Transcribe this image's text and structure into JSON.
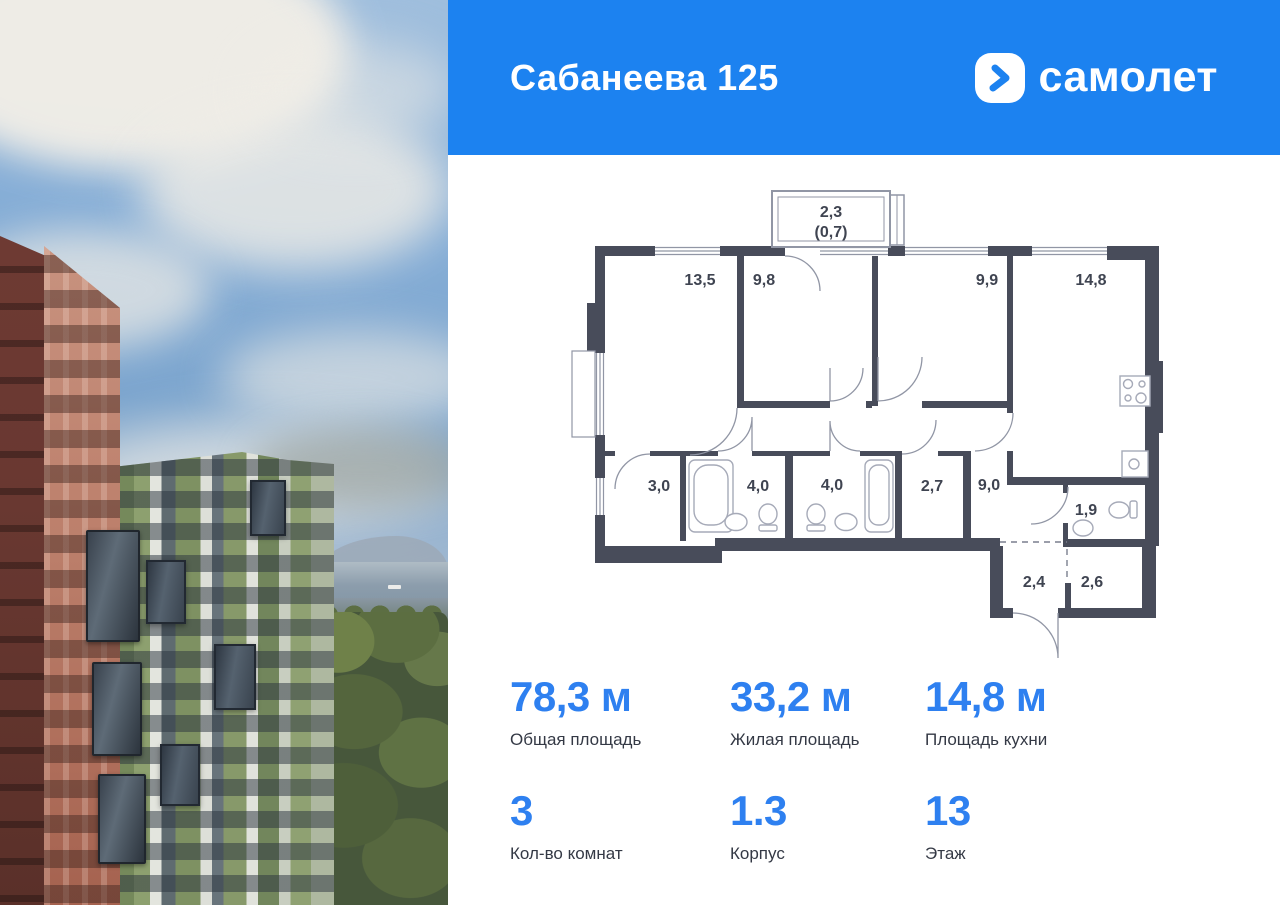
{
  "header": {
    "title": "Сабанеева 125",
    "brand": "самолет"
  },
  "colors": {
    "header_bg": "#1C82F0",
    "accent": "#2E80F0",
    "wall": "#484C5A",
    "plan_line": "#9196A5"
  },
  "plan": {
    "balcony": {
      "area": "2,3",
      "reduced": "(0,7)"
    },
    "room_areas": [
      "13,5",
      "9,8",
      "9,9",
      "14,8",
      "3,0",
      "4,0",
      "4,0",
      "2,7",
      "9,0",
      "1,9",
      "2,4",
      "2,6"
    ]
  },
  "stats": {
    "items": [
      {
        "value": "78,3 м",
        "label": "Общая площадь"
      },
      {
        "value": "33,2 м",
        "label": "Жилая площадь"
      },
      {
        "value": "14,8 м",
        "label": "Площадь кухни"
      },
      {
        "value": "3",
        "label": "Кол-во комнат"
      },
      {
        "value": "1.3",
        "label": "Корпус"
      },
      {
        "value": "13",
        "label": "Этаж"
      }
    ]
  }
}
